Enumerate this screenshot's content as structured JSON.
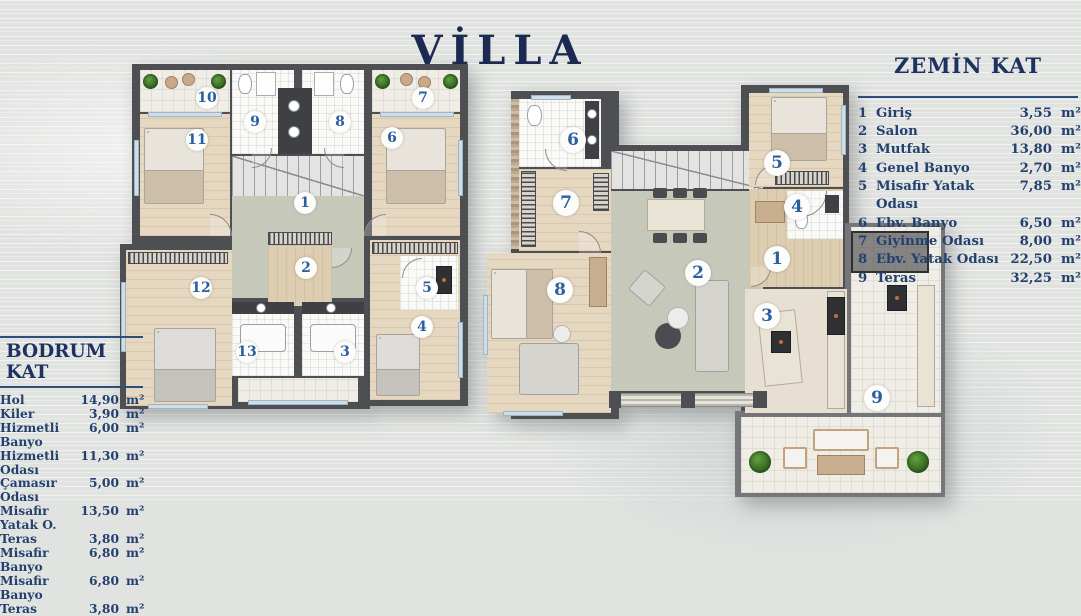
{
  "title": "VİLLA",
  "plans": {
    "bodrum": {
      "rooms": [
        "1",
        "2",
        "3",
        "4",
        "5",
        "6",
        "7",
        "8",
        "9",
        "10",
        "11",
        "12",
        "13"
      ]
    },
    "zemin": {
      "rooms": [
        "1",
        "2",
        "3",
        "4",
        "5",
        "6",
        "7",
        "8",
        "9"
      ]
    }
  },
  "legend_left": {
    "title": "BODRUM KAT",
    "unit": "m²",
    "rows": [
      {
        "name": "Hol",
        "area": "14,90"
      },
      {
        "name": "Kiler",
        "area": "3,90"
      },
      {
        "name": "Hizmetli Banyo",
        "area": "6,00"
      },
      {
        "name": "Hizmetli Odası",
        "area": "11,30"
      },
      {
        "name": "Çamasır Odası",
        "area": "5,00"
      },
      {
        "name": "Misafir Yatak O.",
        "area": "13,50"
      },
      {
        "name": "Teras",
        "area": "3,80"
      },
      {
        "name": "Misafir Banyo",
        "area": "6,80"
      },
      {
        "name": "Misafir Banyo",
        "area": "6,80"
      },
      {
        "name": "Teras",
        "area": "3,80"
      }
    ]
  },
  "legend_right": {
    "title": "ZEMİN KAT",
    "unit": "m²",
    "rows": [
      {
        "num": "1",
        "name": "Giriş",
        "area": "3,55"
      },
      {
        "num": "2",
        "name": "Salon",
        "area": "36,00"
      },
      {
        "num": "3",
        "name": "Mutfak",
        "area": "13,80"
      },
      {
        "num": "4",
        "name": "Genel Banyo",
        "area": "2,70"
      },
      {
        "num": "5",
        "name": "Misafir Yatak Odası",
        "area": "7,85"
      },
      {
        "num": "6",
        "name": "Ebv. Banyo",
        "area": "6,50"
      },
      {
        "num": "7",
        "name": "Giyinme Odası",
        "area": "8,00"
      },
      {
        "num": "8",
        "name": "Ebv. Yatak Odası",
        "area": "22,50"
      },
      {
        "num": "9",
        "name": "Teras",
        "area": "32,25"
      }
    ]
  }
}
